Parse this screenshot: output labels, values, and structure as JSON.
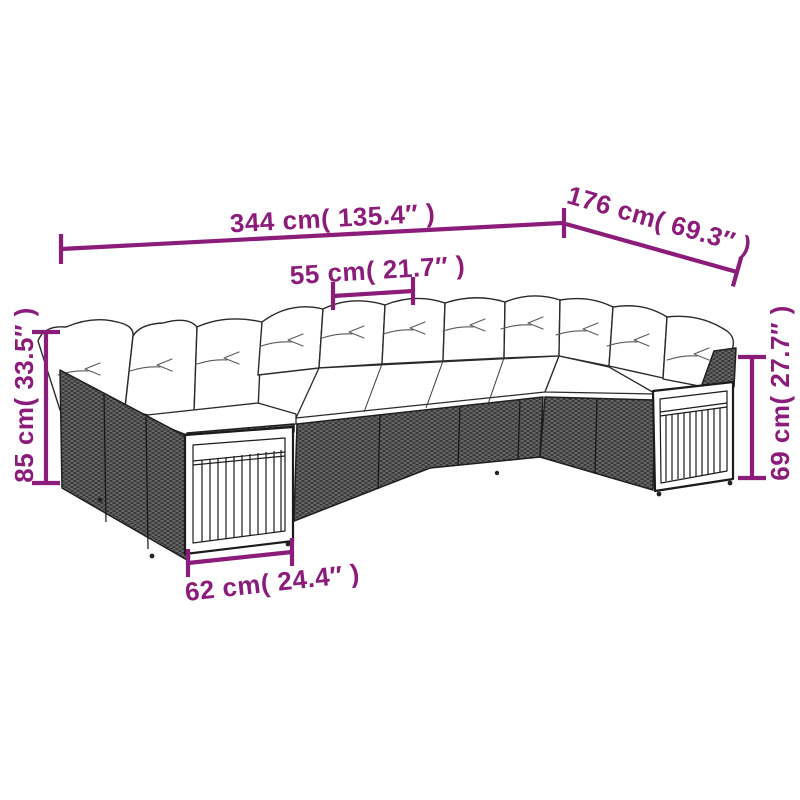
{
  "figure": {
    "background": "#ffffff",
    "accent_color": "#8C1C7A",
    "illustration": {
      "name": "u-shaped-poly-rattan-garden-sofa-set-with-cushions",
      "wicker_color": "#585858",
      "outline_color": "#1f1f1f",
      "cushion_color": "#ffffff"
    },
    "dimensions": {
      "overall_width": "344 cm( 135.4″ )",
      "overall_depth": "176 cm( 69.3″ )",
      "seat_width": "55 cm( 21.7″ )",
      "back_height": "85 cm( 33.5″ )",
      "arm_height": "69 cm( 27.7″ )",
      "arm_depth": "62 cm( 24.4″ )"
    }
  }
}
